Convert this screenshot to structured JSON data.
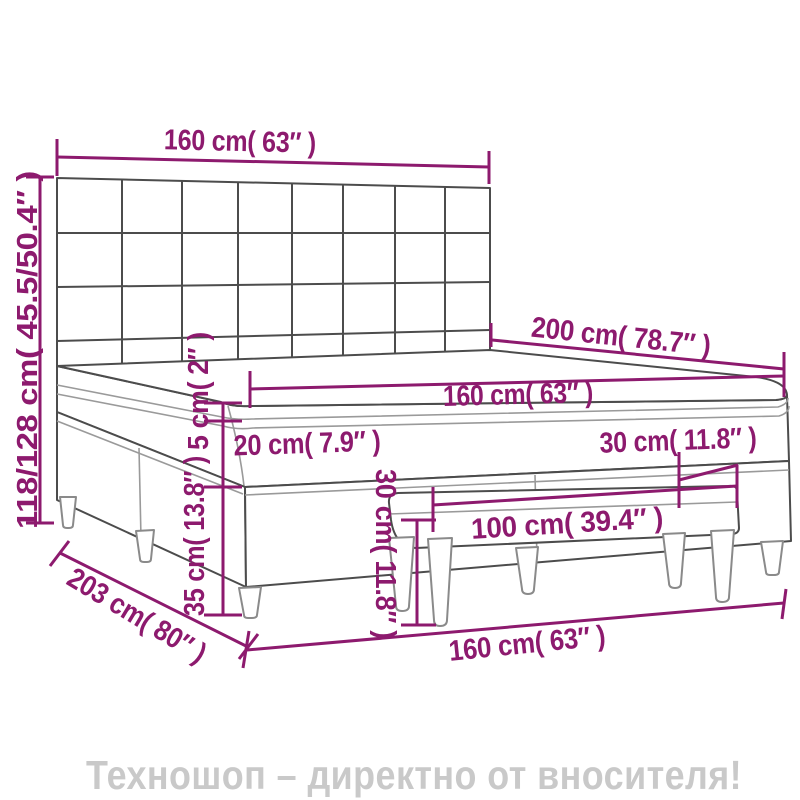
{
  "diagram": {
    "type": "product-dimension-drawing",
    "subject": "box spring bed with tufted headboard, mattress and bench",
    "dimensions": {
      "headboard_width": "160 cm( 63″ )",
      "total_height": "118/128 cm( 45.5/50.4″ )",
      "bed_length": "200 cm( 78.7″ )",
      "mattress_width": "160 cm( 63″ )",
      "pillow_top_height": "5 cm( 2″ )",
      "mattress_height": "20 cm( 7.9″ )",
      "side_gap": "30 cm( 11.8″ )",
      "bench_length": "100 cm( 39.4″ )",
      "bench_height": "30 cm( 11.8″ )",
      "base_height": "35 cm( 13.8″ )",
      "base_length": "203 cm( 80″ )",
      "base_width": "160 cm( 63″ )"
    }
  },
  "watermark": {
    "text": "Техношоп – директно от вносителя!"
  },
  "colors": {
    "dimension": "#8d1a6e",
    "outline": "#4c4c4c",
    "soft": "#9a9a9a",
    "legs": "#8a8a8a",
    "watermark": "#c9c9c9",
    "background": "#ffffff"
  }
}
